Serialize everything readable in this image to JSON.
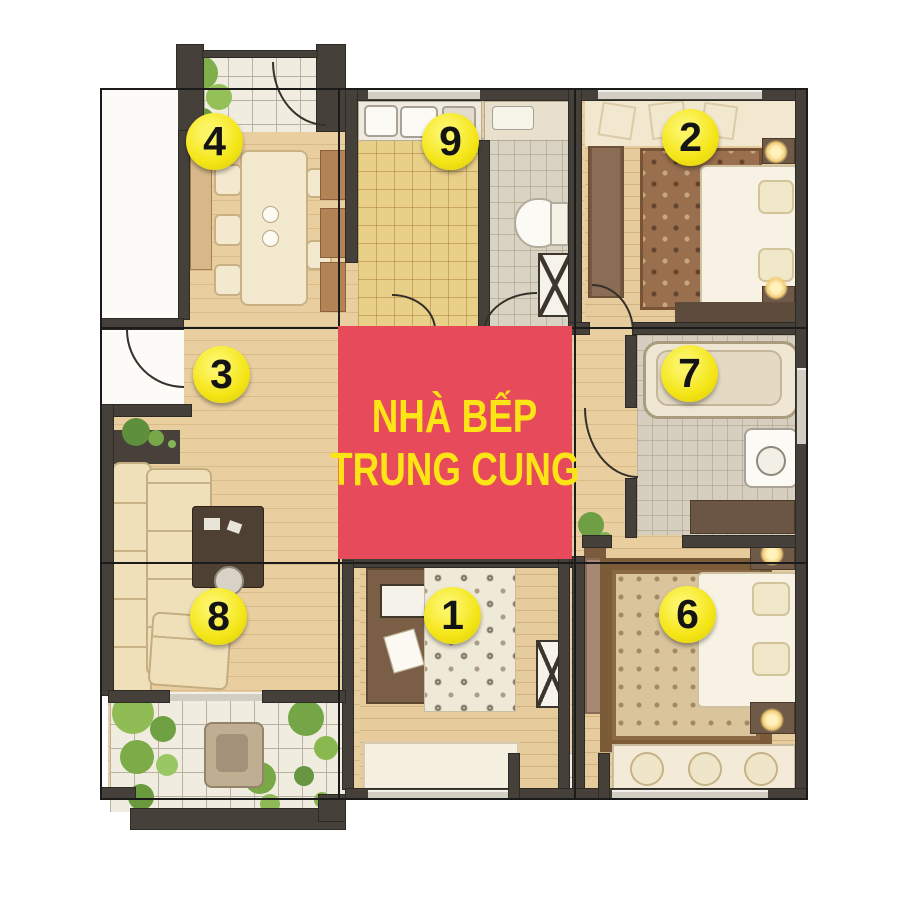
{
  "plan": {
    "type": "apartment-floorplan-with-luoshu-grid",
    "center_label": {
      "line1": "NHÀ BẾP",
      "line2": "TRUNG CUNG",
      "bg_color": "#e74b5b",
      "text_color": "#fde515"
    },
    "sector_markers": [
      {
        "number": "4",
        "cx": 215,
        "cy": 142
      },
      {
        "number": "9",
        "cx": 451,
        "cy": 142
      },
      {
        "number": "2",
        "cx": 691,
        "cy": 138
      },
      {
        "number": "3",
        "cx": 222,
        "cy": 375
      },
      {
        "number": "7",
        "cx": 690,
        "cy": 374
      },
      {
        "number": "8",
        "cx": 219,
        "cy": 617
      },
      {
        "number": "1",
        "cx": 453,
        "cy": 616
      },
      {
        "number": "6",
        "cx": 688,
        "cy": 615
      }
    ],
    "marker_style": {
      "fill": "#f4e516",
      "text_color": "#141414",
      "diameter_px": 57
    },
    "grid": {
      "x": 100,
      "y": 88,
      "width": 708,
      "height": 712,
      "rows": 3,
      "cols": 3,
      "line_color": "#1b1b1b"
    }
  }
}
